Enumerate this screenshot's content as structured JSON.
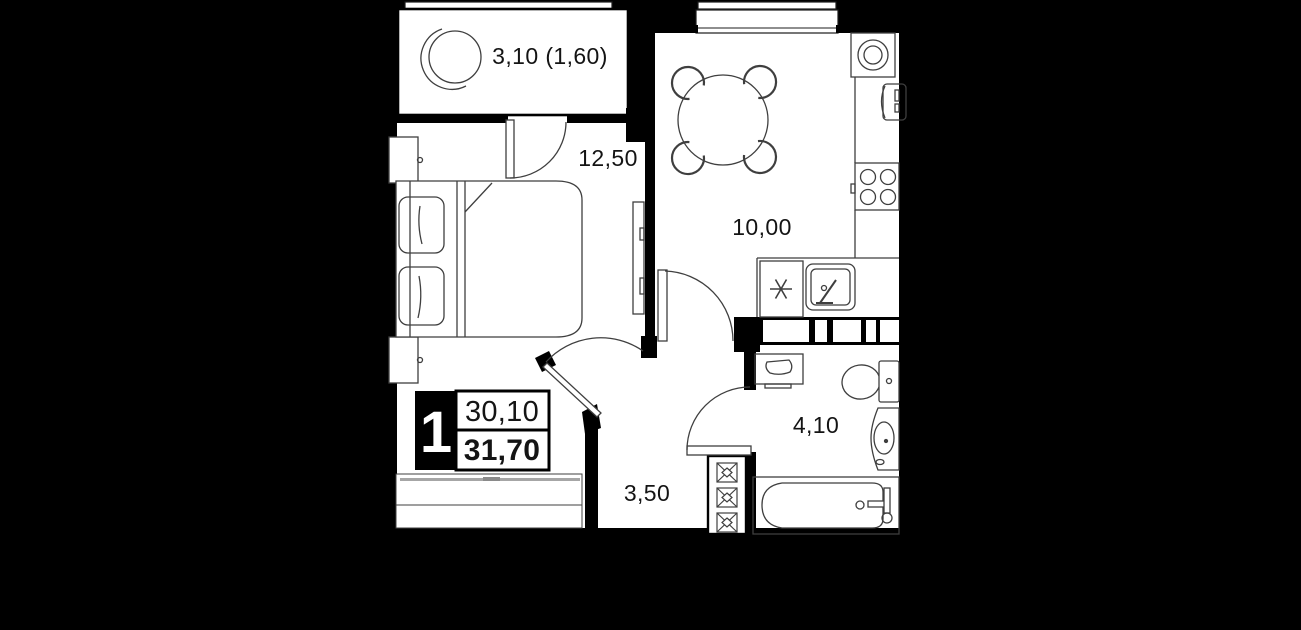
{
  "plan": {
    "badge": {
      "rooms_count": "1",
      "area_living": "30,10",
      "area_total": "31,70"
    },
    "rooms": [
      {
        "name": "balcony",
        "label": "3,10 (1,60)"
      },
      {
        "name": "bedroom",
        "label": "12,50"
      },
      {
        "name": "kitchen-living",
        "label": "10,00"
      },
      {
        "name": "hallway",
        "label": "3,50"
      },
      {
        "name": "bathroom",
        "label": "4,10"
      }
    ],
    "colors": {
      "background": "#000000",
      "walls": "#000000",
      "floor": "#ffffff",
      "furniture_stroke": "#3f3f3f",
      "accent_gray": "#a6a6a6"
    }
  }
}
